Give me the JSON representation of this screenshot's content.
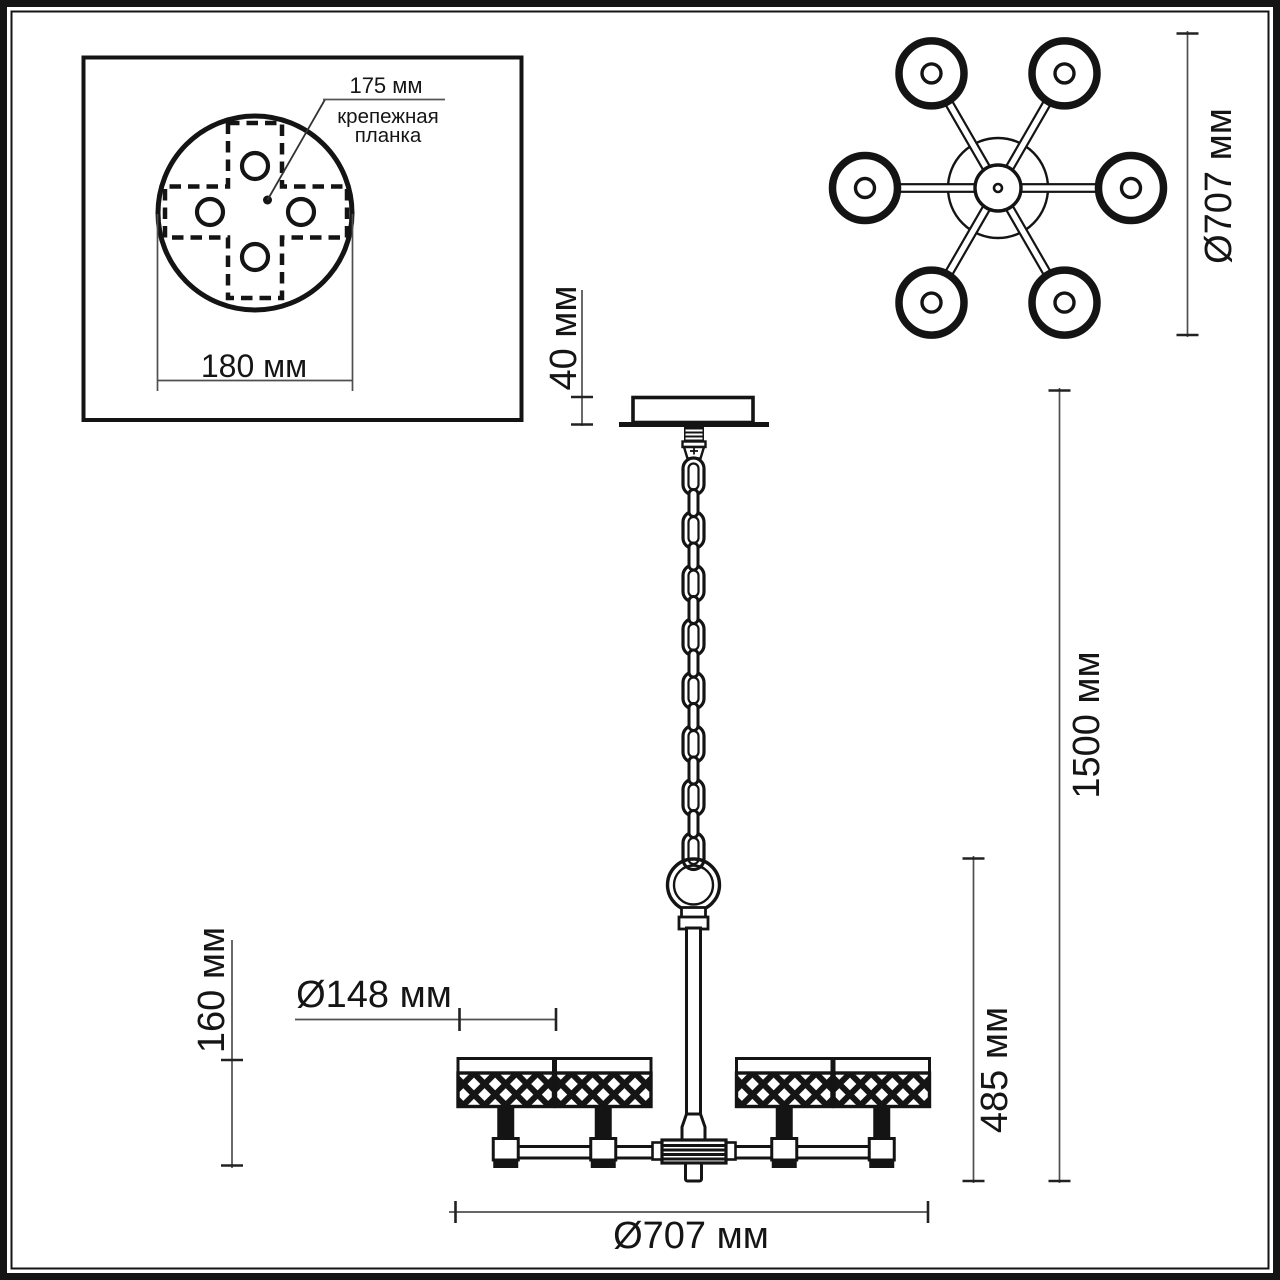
{
  "drawing": {
    "inset": {
      "plate_pitch": "175 мм",
      "bracket_label_line1": "крепежная",
      "bracket_label_line2": "планка",
      "plate_width": "180 мм"
    },
    "top_view": {
      "fixture_diameter": "Ø707 мм"
    },
    "side_view": {
      "canopy_height": "40 мм",
      "shade_height": "160 мм",
      "shade_diameter": "Ø148 мм",
      "body_height": "485 мм",
      "suspension_height": "1500 мм",
      "fixture_diameter": "Ø707 мм"
    }
  },
  "colors": {
    "ink": "#141414",
    "dimension_line": "#4f4f4f",
    "background": "#ffffff"
  }
}
